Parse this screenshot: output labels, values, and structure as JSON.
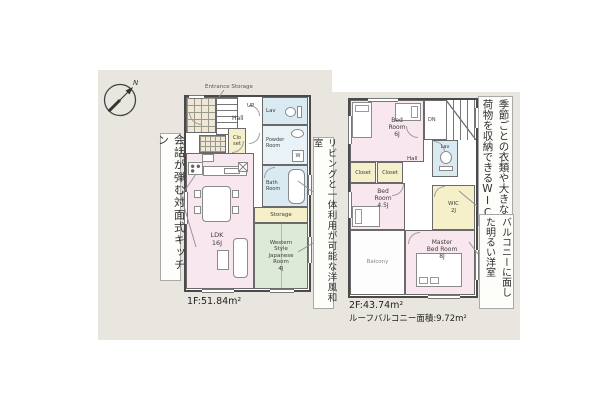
{
  "compass": {
    "north_label": "N"
  },
  "floor1": {
    "entrance_label": "Entrance Storage",
    "area_label": "1F:51.84m²",
    "rooms": {
      "up": "UP",
      "hall": "Hall",
      "lav": "Lav",
      "closet": "Clo\nset",
      "powder_room": "Powder\nRoom",
      "washer": "W",
      "bath_room": "Bath\nRoom",
      "storage": "Storage",
      "ldk": "LDK\n16J",
      "japanese_room": "Western\nStyle\nJapanese\nRoom\n4J"
    }
  },
  "floor2": {
    "area_label": "2F:43.74m²",
    "roof_balcony_label": "ルーフバルコニー面積:9.72m²",
    "rooms": {
      "bed_room_6j": "Bed\nRoom\n6J",
      "dn": "DN",
      "lav": "Lav",
      "closet_left": "Closet",
      "closet_right": "Closet",
      "hall": "Hall",
      "wic": "WIC\n2J",
      "bed_room_45j": "Bed\nRoom\n4.5J",
      "balcony": "Balcony",
      "master_bed_room": "Master\nBed Room\n8J"
    }
  },
  "annotations": {
    "kitchen_note": "会話が弾む対面式キッチン",
    "japanese_room_note": "リビングと一体利用が可能な洋風和室",
    "wic_note": "季節ごとの衣類や大きな荷物を収納できるWIC",
    "balcony_room_note": "バルコニーに面した明るい洋室"
  },
  "colors": {
    "panel_bg": "#e9e6df",
    "wall": "#4a4a4a",
    "room_pink": "#f8e7ee",
    "room_yellow": "#f5efca",
    "room_green": "#dcead6",
    "room_blue": "#d9eaf3",
    "room_blue_light": "#e9f2f7",
    "tile_beige": "#efe8d6",
    "note_border": "#a8a8a8"
  }
}
